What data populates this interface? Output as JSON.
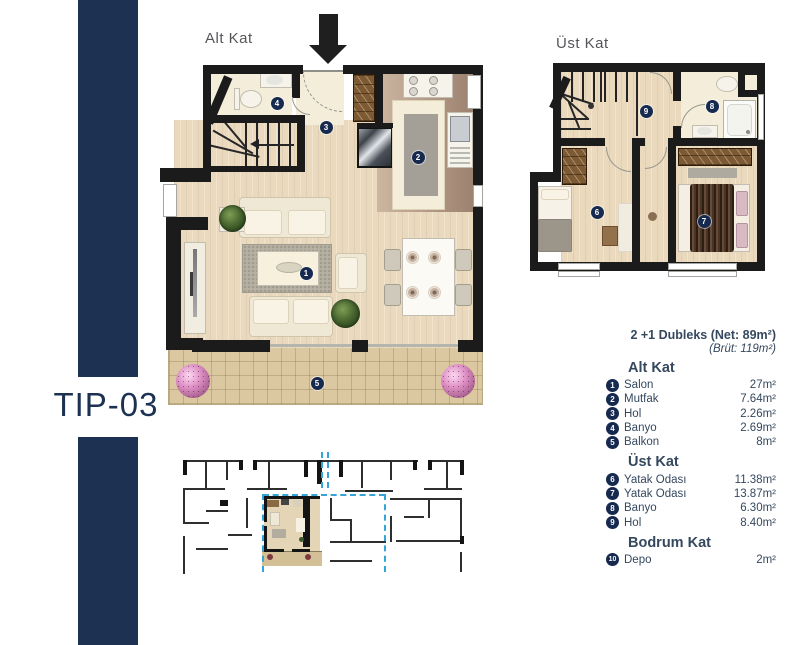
{
  "tip_label": "TIP-03",
  "plans": {
    "alt_label": "Alt Kat",
    "ust_label": "Üst Kat"
  },
  "floor_markers": [
    "1",
    "2",
    "3",
    "4",
    "5",
    "6",
    "7",
    "8",
    "9"
  ],
  "legend": {
    "title": "2 +1 Dubleks (Net: 89m²)",
    "subtitle": "(Brüt: 119m²)",
    "sections": [
      {
        "header": "Alt Kat",
        "rows": [
          {
            "num": "1",
            "label": "Salon",
            "area": "27m²"
          },
          {
            "num": "2",
            "label": "Mutfak",
            "area": "7.64m²"
          },
          {
            "num": "3",
            "label": "Hol",
            "area": "2.26m²"
          },
          {
            "num": "4",
            "label": "Banyo",
            "area": "2.69m²"
          },
          {
            "num": "5",
            "label": "Balkon",
            "area": "8m²"
          }
        ]
      },
      {
        "header": "Üst Kat",
        "rows": [
          {
            "num": "6",
            "label": "Yatak Odası",
            "area": "11.38m²"
          },
          {
            "num": "7",
            "label": "Yatak Odası",
            "area": "13.87m²"
          },
          {
            "num": "8",
            "label": "Banyo",
            "area": "6.30m²"
          },
          {
            "num": "9",
            "label": "Hol",
            "area": "8.40m²"
          }
        ]
      },
      {
        "header": "Bodrum Kat",
        "rows": [
          {
            "num": "10",
            "label": "Depo",
            "area": "2m²"
          }
        ]
      }
    ]
  },
  "colors": {
    "navy_bar": "#1d3153",
    "marker_navy": "#16294e",
    "legend_text": "#35485e",
    "dashed_blue": "#34a4d8",
    "wood_floor": "#ead9bd",
    "cream_floor": "#f3edd9",
    "balcony_tile": "#dbc8a0",
    "wardrobe_brown": "#7d5a33",
    "wall_black": "#1b1b1b"
  }
}
